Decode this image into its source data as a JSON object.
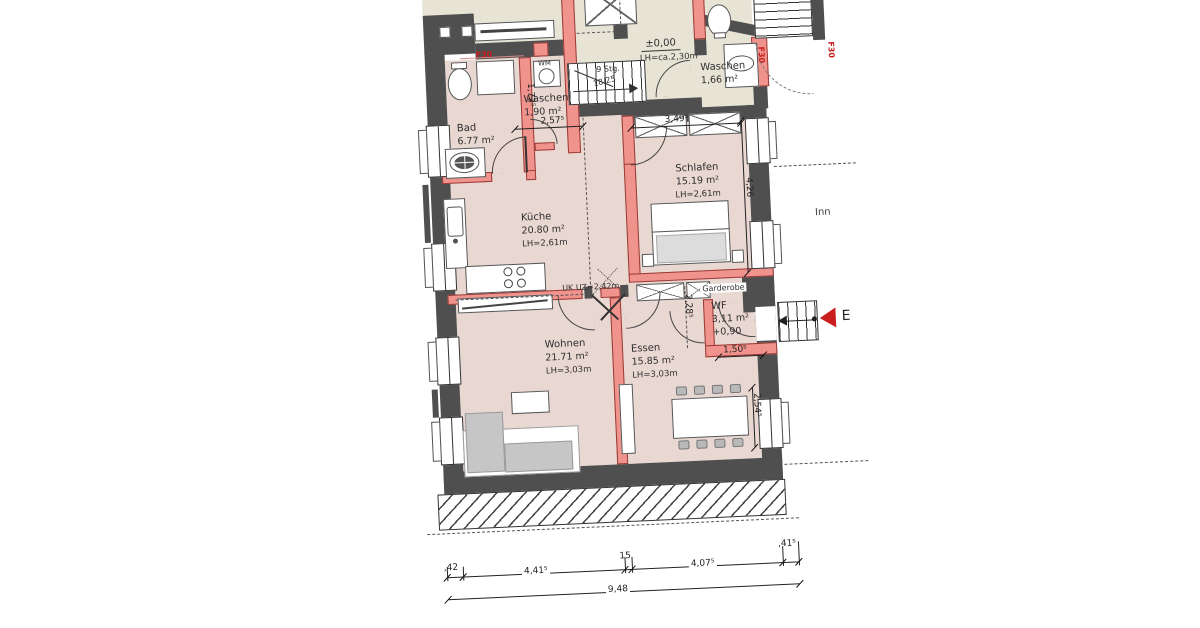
{
  "colors": {
    "existing_wall": "#4f4f4f",
    "new_wall": "#f0938d",
    "room_fill": "#e9d7d1",
    "upper_room_fill": "#e7e4d6",
    "accent_red": "#c81e1e"
  },
  "rooms": {
    "bad": {
      "name": "Bad",
      "area": "6.77 m²"
    },
    "waschen_og": {
      "name": "Waschen",
      "area": "1,90 m²"
    },
    "kueche": {
      "name": "Küche",
      "area": "20.80 m²",
      "lh": "LH=2,61m"
    },
    "schlafen": {
      "name": "Schlafen",
      "area": "15.19 m²",
      "lh": "LH=2,61m"
    },
    "wohnen": {
      "name": "Wohnen",
      "area": "21.71 m²",
      "lh": "LH=3,03m"
    },
    "essen": {
      "name": "Essen",
      "area": "15.85 m²",
      "lh": "LH=3,03m"
    },
    "wf": {
      "name": "WF",
      "area": "3,11 m²",
      "level": "+0,90"
    },
    "waschen_eg": {
      "name": "Waschen",
      "area": "1,66 m²"
    },
    "garderobe": {
      "name": "Garderobe"
    }
  },
  "hall": {
    "level": "±0,00",
    "clearance": "LH=ca.2,30m"
  },
  "stairs": {
    "steps": "9 Stg.",
    "rise_run": "18/25"
  },
  "beam": {
    "label": "UK UZ=2,42m"
  },
  "labels": {
    "fire_rating": "F30",
    "entrance": "E",
    "context": "Inn",
    "washing_machine": "WM"
  },
  "dimensions": {
    "waschen_height": "1,72⁵",
    "hall_top": "2,57⁵",
    "schlafen_width": "3,49⁵",
    "schlafen_depth": "4,26",
    "essen_depth": "2,28⁵",
    "wf_width": "1,50⁵",
    "essen_window": "2,54⁵",
    "bottom_seg_1": ",42",
    "bottom_seg_2": "4,41⁵",
    "bottom_seg_3": "15",
    "bottom_seg_4": "4,07⁵",
    "bottom_seg_5": ",41⁵",
    "bottom_total": "9,48"
  }
}
